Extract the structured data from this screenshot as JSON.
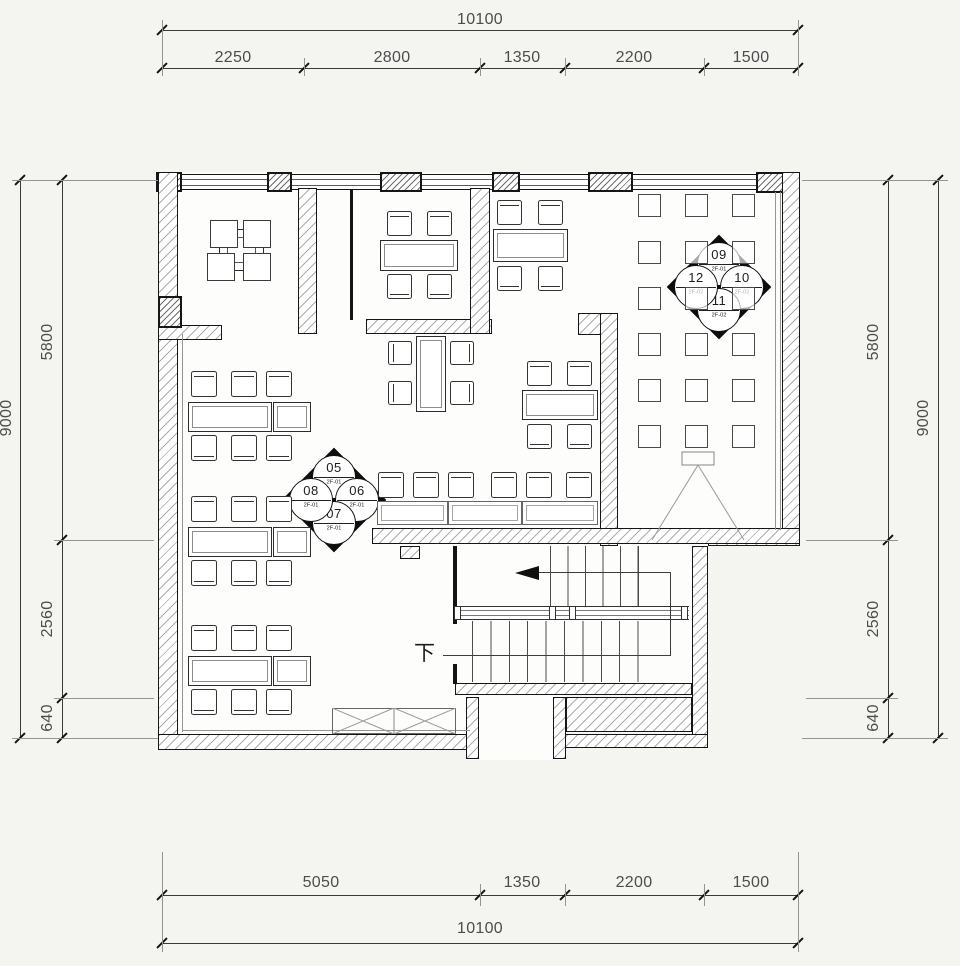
{
  "dimensions": {
    "top": {
      "total": "10100",
      "segments": [
        "2250",
        "2800",
        "1350",
        "2200",
        "1500"
      ]
    },
    "bottom": {
      "total": "10100",
      "segments": [
        "5050",
        "1350",
        "2200",
        "1500"
      ]
    },
    "left": {
      "total": "9000",
      "segments": [
        "5800",
        "2560",
        "640"
      ]
    },
    "right": {
      "total": "9000",
      "segments": [
        "5800",
        "2560",
        "640"
      ]
    }
  },
  "markers": {
    "left_group": {
      "n": {
        "num": "05",
        "ref": "2F-01"
      },
      "e": {
        "num": "06",
        "ref": "2F-01"
      },
      "s": {
        "num": "07",
        "ref": "2F-01"
      },
      "w": {
        "num": "08",
        "ref": "2F-01"
      }
    },
    "right_group": {
      "n": {
        "num": "09",
        "ref": "2F-01"
      },
      "e": {
        "num": "10",
        "ref": "2F-02"
      },
      "s": {
        "num": "11",
        "ref": "2F-02"
      },
      "w": {
        "num": "12",
        "ref": "2F-02"
      }
    }
  },
  "stairs": {
    "down_label": "下"
  },
  "colors": {
    "background": "#f4f4f1",
    "line": "#161616",
    "dim_text": "#4c4c4c",
    "marker_fill": "#0c0c0c"
  }
}
